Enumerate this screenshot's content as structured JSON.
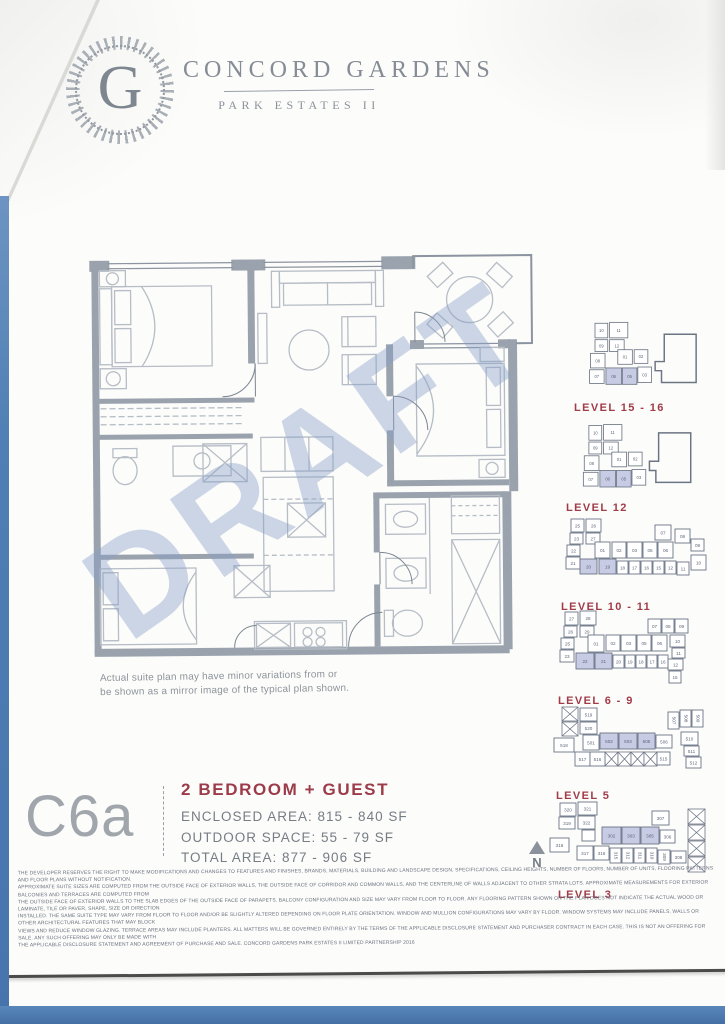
{
  "header": {
    "logo_letter": "G",
    "title": "CONCORD GARDENS",
    "subtitle": "PARK ESTATES II"
  },
  "floorplan": {
    "watermark": "DRAFT",
    "caption_line1": "Actual suite plan may have minor variations from or",
    "caption_line2": "be shown as a mirror image of the typical plan shown."
  },
  "unit": {
    "code": "C6a",
    "type": "2 BEDROOM + GUEST",
    "enclosed_area": "ENCLOSED AREA: 815 - 840 SF",
    "outdoor_space": "OUTDOOR SPACE: 55 - 79 SF",
    "total_area": "TOTAL AREA: 877 - 906 SF"
  },
  "compass": {
    "label": "N"
  },
  "colors": {
    "accent_red": "#9c3b49",
    "keyplan_highlight": "#c7cce4",
    "wall_gray": "#9aa3ad",
    "blue_edge": "#4f7fb5",
    "watermark_blue": "#88a0c7"
  },
  "keyplans": [
    {
      "label": "LEVEL 15 - 16",
      "viewBox": "0 0 150 90",
      "outline": "106,20 141,20 141,73 103,73 103,60 96,60 96,50 106,50",
      "boxes": [
        [
          30,
          8,
          14,
          16,
          "10",
          0
        ],
        [
          46,
          7,
          20,
          17,
          "11",
          0
        ],
        [
          30,
          26,
          14,
          13,
          "09",
          0
        ],
        [
          46,
          26,
          16,
          13,
          "12",
          0
        ],
        [
          25,
          41,
          16,
          16,
          "08",
          0
        ],
        [
          24,
          59,
          16,
          15,
          "07",
          0
        ],
        [
          55,
          37,
          16,
          16,
          "01",
          0
        ],
        [
          73,
          37,
          15,
          15,
          "02",
          0
        ],
        [
          42,
          57,
          17,
          18,
          "06",
          1
        ],
        [
          60,
          57,
          16,
          18,
          "05",
          1
        ],
        [
          77,
          56,
          15,
          17,
          "03",
          0
        ]
      ]
    },
    {
      "label": "LEVEL 12",
      "viewBox": "0 0 150 85",
      "outline": "104,14 139,14 139,68 101,68 101,55 94,55 94,45 104,45",
      "boxes": [
        [
          28,
          6,
          14,
          16,
          "10",
          0
        ],
        [
          44,
          5,
          20,
          17,
          "11",
          0
        ],
        [
          28,
          24,
          14,
          13,
          "09",
          0
        ],
        [
          44,
          24,
          16,
          13,
          "12",
          0
        ],
        [
          23,
          39,
          16,
          16,
          "08",
          0
        ],
        [
          22,
          57,
          16,
          15,
          "07",
          0
        ],
        [
          53,
          35,
          16,
          16,
          "01",
          0
        ],
        [
          71,
          35,
          15,
          15,
          "02",
          0
        ],
        [
          40,
          55,
          17,
          18,
          "06",
          1
        ],
        [
          58,
          55,
          16,
          18,
          "05",
          1
        ],
        [
          75,
          54,
          15,
          17,
          "03",
          0
        ]
      ]
    },
    {
      "label": "LEVEL 10 - 11",
      "viewBox": "0 0 165 82",
      "boxes": [
        [
          16,
          4,
          13,
          13,
          "25",
          0
        ],
        [
          31,
          4,
          15,
          13,
          "26",
          0
        ],
        [
          15,
          18,
          13,
          11,
          "23",
          0
        ],
        [
          31,
          18,
          14,
          11,
          "27",
          0
        ],
        [
          12,
          30,
          13,
          11,
          "22",
          0
        ],
        [
          11,
          42,
          14,
          12,
          "21",
          0
        ],
        [
          40,
          27,
          15,
          16,
          "01",
          0
        ],
        [
          57,
          27,
          14,
          16,
          "02",
          0
        ],
        [
          72,
          27,
          15,
          16,
          "03",
          0
        ],
        [
          88,
          27,
          14,
          16,
          "05",
          0
        ],
        [
          103,
          27,
          15,
          16,
          "06",
          0
        ],
        [
          100,
          10,
          16,
          15,
          "07",
          0
        ],
        [
          120,
          14,
          15,
          14,
          "08",
          0
        ],
        [
          136,
          24,
          13,
          12,
          "09",
          0
        ],
        [
          25,
          44,
          17,
          15,
          "20",
          1
        ],
        [
          44,
          44,
          17,
          15,
          "19",
          1
        ],
        [
          62,
          46,
          11,
          13,
          "18",
          0
        ],
        [
          74,
          46,
          11,
          13,
          "17",
          0
        ],
        [
          86,
          46,
          11,
          13,
          "16",
          0
        ],
        [
          98,
          46,
          11,
          13,
          "15",
          0
        ],
        [
          110,
          46,
          11,
          13,
          "12",
          0
        ],
        [
          122,
          47,
          12,
          13,
          "11",
          0
        ],
        [
          136,
          40,
          15,
          15,
          "10",
          0
        ]
      ]
    },
    {
      "label": "LEVEL 6 - 9",
      "viewBox": "0 0 168 84",
      "boxes": [
        [
          15,
          5,
          13,
          13,
          "27",
          0
        ],
        [
          30,
          4,
          16,
          14,
          "28",
          0
        ],
        [
          14,
          19,
          13,
          11,
          "26",
          0
        ],
        [
          30,
          19,
          14,
          11,
          "29",
          0
        ],
        [
          11,
          31,
          13,
          11,
          "25",
          0
        ],
        [
          10,
          43,
          14,
          12,
          "23",
          0
        ],
        [
          38,
          28,
          16,
          17,
          "01",
          0
        ],
        [
          56,
          28,
          14,
          16,
          "02",
          0
        ],
        [
          71,
          28,
          15,
          16,
          "03",
          0
        ],
        [
          87,
          28,
          14,
          16,
          "05",
          0
        ],
        [
          102,
          28,
          15,
          16,
          "06",
          0
        ],
        [
          98,
          12,
          13,
          14,
          "07",
          0
        ],
        [
          112,
          12,
          12,
          14,
          "08",
          0
        ],
        [
          125,
          12,
          13,
          14,
          "09",
          0
        ],
        [
          120,
          28,
          15,
          12,
          "10",
          0
        ],
        [
          122,
          41,
          13,
          10,
          "11",
          0
        ],
        [
          118,
          52,
          15,
          11,
          "12",
          0
        ],
        [
          26,
          46,
          18,
          16,
          "22",
          1
        ],
        [
          45,
          46,
          17,
          16,
          "21",
          1
        ],
        [
          63,
          48,
          11,
          13,
          "20",
          0
        ],
        [
          75,
          48,
          10,
          13,
          "19",
          0
        ],
        [
          86,
          48,
          10,
          13,
          "18",
          0
        ],
        [
          97,
          48,
          10,
          13,
          "17",
          0
        ],
        [
          108,
          48,
          10,
          13,
          "16",
          0
        ],
        [
          119,
          64,
          12,
          12,
          "15",
          0
        ]
      ]
    },
    {
      "label": "LEVEL 5",
      "viewBox": "0 0 168 84",
      "cross": [
        [
          12,
          5,
          16,
          14
        ],
        [
          12,
          20,
          16,
          14
        ],
        [
          55,
          50,
          13,
          14
        ],
        [
          68,
          50,
          13,
          14
        ],
        [
          81,
          50,
          13,
          14
        ],
        [
          94,
          50,
          13,
          14
        ]
      ],
      "boxes": [
        [
          30,
          6,
          17,
          13,
          "519",
          0
        ],
        [
          30,
          20,
          17,
          12,
          "520",
          0
        ],
        [
          4,
          36,
          20,
          14,
          "518",
          0
        ],
        [
          33,
          33,
          16,
          15,
          "501",
          0
        ],
        [
          50,
          31,
          18,
          16,
          "502",
          1
        ],
        [
          69,
          31,
          18,
          16,
          "503",
          1
        ],
        [
          88,
          31,
          17,
          16,
          "505",
          1
        ],
        [
          106,
          33,
          16,
          13,
          "506",
          0
        ],
        [
          25,
          50,
          15,
          14,
          "517",
          0
        ],
        [
          40,
          50,
          15,
          14,
          "516",
          0
        ],
        [
          107,
          50,
          13,
          13,
          "515",
          0
        ],
        [
          118,
          10,
          11,
          17,
          "507",
          0,
          1
        ],
        [
          130,
          8,
          11,
          17,
          "508",
          0,
          1
        ],
        [
          142,
          8,
          11,
          17,
          "509",
          0,
          1
        ],
        [
          131,
          30,
          17,
          13,
          "510",
          0
        ],
        [
          134,
          44,
          15,
          10,
          "511",
          0
        ],
        [
          136,
          55,
          15,
          11,
          "512",
          0
        ]
      ]
    },
    {
      "label": "LEVEL 3",
      "viewBox": "0 0 175 88",
      "cross": [
        [
          142,
          12,
          17,
          15
        ],
        [
          142,
          28,
          17,
          15
        ],
        [
          142,
          44,
          17,
          15
        ],
        [
          142,
          60,
          17,
          15
        ]
      ],
      "boxes": [
        [
          14,
          6,
          16,
          13,
          "320",
          0
        ],
        [
          32,
          5,
          19,
          13,
          "321",
          0
        ],
        [
          13,
          20,
          16,
          12,
          "319",
          0
        ],
        [
          32,
          19,
          17,
          13,
          "322",
          0
        ],
        [
          36,
          33,
          13,
          11,
          "",
          0
        ],
        [
          4,
          41,
          19,
          14,
          "318",
          0
        ],
        [
          56,
          30,
          19,
          17,
          "302",
          1
        ],
        [
          76,
          30,
          18,
          17,
          "303",
          1
        ],
        [
          95,
          30,
          18,
          17,
          "305",
          1
        ],
        [
          114,
          33,
          15,
          13,
          "306",
          0
        ],
        [
          106,
          14,
          17,
          14,
          "307",
          0
        ],
        [
          31,
          49,
          16,
          14,
          "317",
          0
        ],
        [
          48,
          49,
          15,
          14,
          "316",
          0
        ],
        [
          64,
          51,
          11,
          15,
          "315",
          0,
          1
        ],
        [
          76,
          51,
          11,
          15,
          "312",
          0,
          1
        ],
        [
          88,
          51,
          11,
          15,
          "311",
          0,
          1
        ],
        [
          100,
          51,
          11,
          15,
          "310",
          0,
          1
        ],
        [
          112,
          53,
          12,
          14,
          "309",
          0,
          1
        ],
        [
          125,
          54,
          15,
          12,
          "308",
          0
        ]
      ]
    }
  ],
  "disclaimer": {
    "lines": [
      "THE DEVELOPER RESERVES THE RIGHT TO MAKE MODIFICATIONS AND CHANGES TO FEATURES AND FINISHES, BRANDS, MATERIALS, BUILDING AND LANDSCAPE DESIGN, SPECIFICATIONS, CEILING HEIGHTS, NUMBER OF FLOORS, NUMBER OF UNITS, FLOORING PATTERNS AND FLOOR PLANS WITHOUT NOTIFICATION.",
      "APPROXIMATE SUITE SIZES ARE COMPUTED FROM THE OUTSIDE FACE OF EXTERIOR WALLS, THE OUTSIDE FACE OF CORRIDOR AND COMMON WALLS, AND THE CENTERLINE OF WALLS ADJACENT TO OTHER STRATA LOTS. APPROXIMATE MEASUREMENTS FOR EXTERIOR BALCONIES AND TERRACES ARE COMPUTED FROM",
      "THE OUTSIDE FACE OF EXTERIOR WALLS TO THE SLAB EDGES OF THE OUTSIDE FACE OF PARAPETS. BALCONY CONFIGURATION AND SIZE MAY VARY FROM FLOOR TO FLOOR. ANY FLOORING PATTERN SHOWN ON THE PLAN DOES NOT INDICATE THE ACTUAL WOOD OR LAMINATE, TILE OR PAVER, SHAPE, SIZE OR DIRECTION",
      "INSTALLED. THE SAME SUITE TYPE MAY VARY FROM FLOOR TO FLOOR AND/OR BE SLIGHTLY ALTERED DEPENDING ON FLOOR PLATE ORIENTATION. WINDOW AND MULLION CONFIGURATIONS MAY VARY BY FLOOR. WINDOW SYSTEMS MAY INCLUDE PANELS, WALLS OR OTHER ARCHITECTURAL FEATURES THAT MAY BLOCK",
      "VIEWS AND REDUCE WINDOW GLAZING. TERRACE AREAS MAY INCLUDE PLANTERS. ALL MATTERS WILL BE GOVERNED ENTIRELY BY THE TERMS OF THE APPLICABLE DISCLOSURE STATEMENT AND PURCHASER CONTRACT IN EACH CASE. THIS IS NOT AN OFFERING FOR SALE. ANY SUCH OFFERING MAY ONLY BE MADE WITH",
      "THE APPLICABLE DISCLOSURE STATEMENT AND AGREEMENT OF PURCHASE AND SALE. CONCORD GARDENS PARK ESTATES II LIMITED PARTNERSHIP 2016"
    ]
  }
}
